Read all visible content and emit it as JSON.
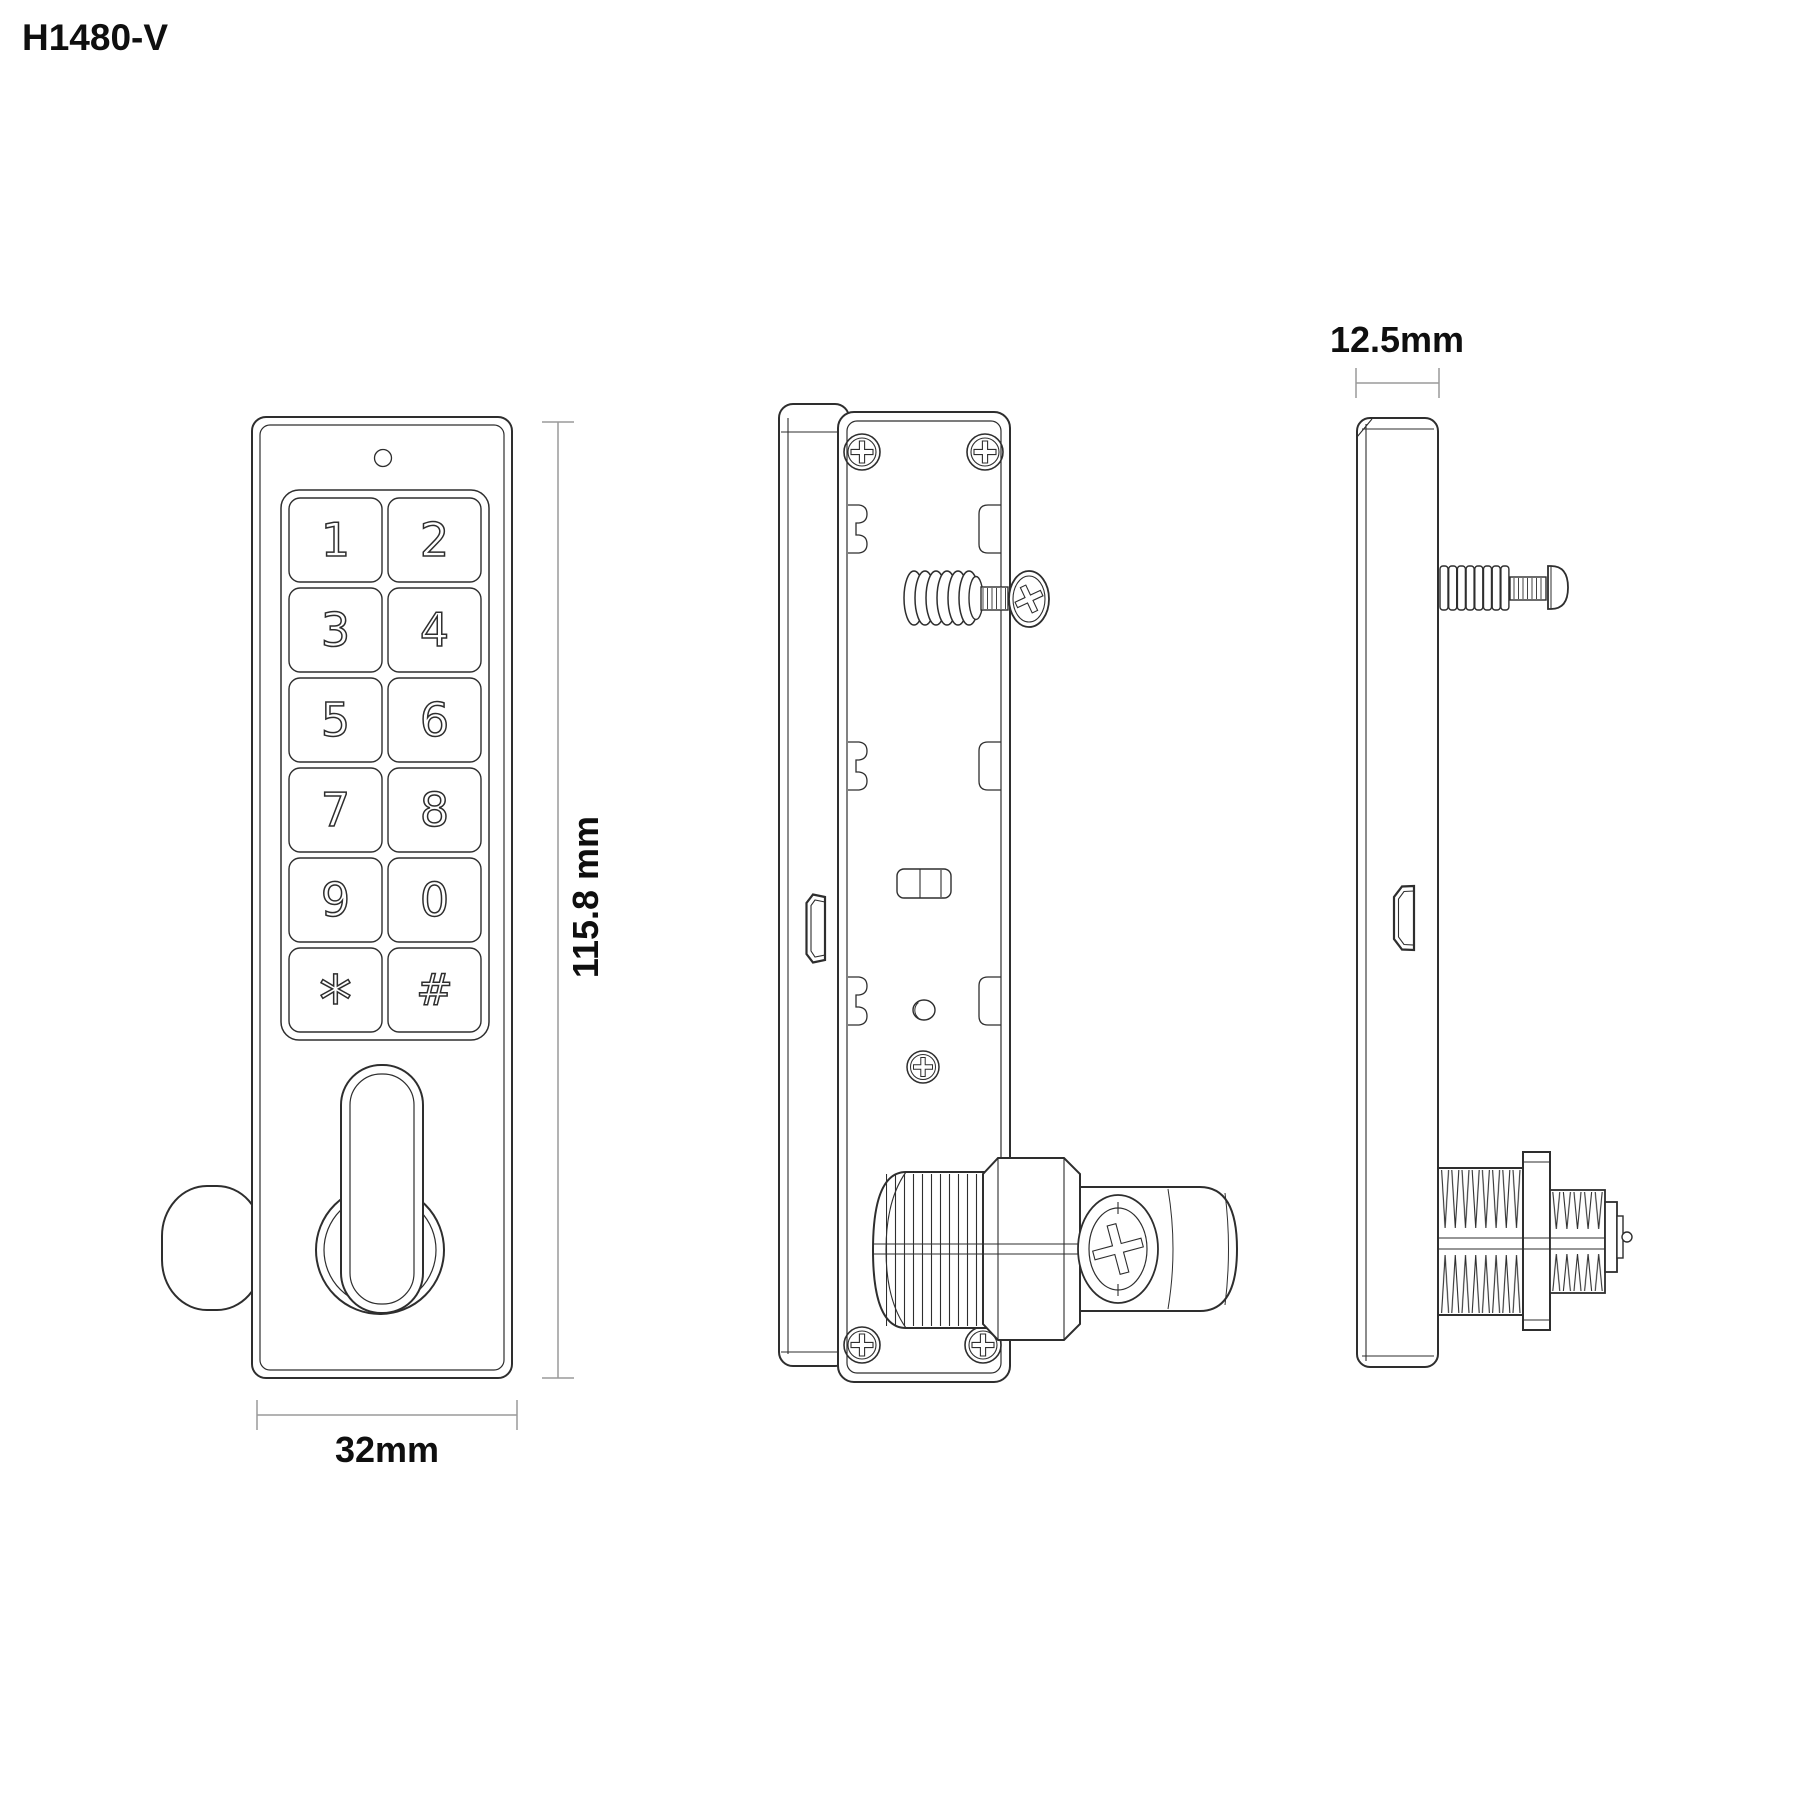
{
  "title": "H1480-V",
  "dimensions": {
    "height": "115.8 mm",
    "width": "32mm",
    "depth": "12.5mm"
  },
  "keypad": {
    "keys": [
      "1",
      "2",
      "3",
      "4",
      "5",
      "6",
      "7",
      "8",
      "9",
      "0",
      "*",
      "#"
    ]
  },
  "colors": {
    "line": "#2e2e2e",
    "dim": "#9a9a9a",
    "text": "#0f0f0f",
    "background": "#ffffff"
  }
}
